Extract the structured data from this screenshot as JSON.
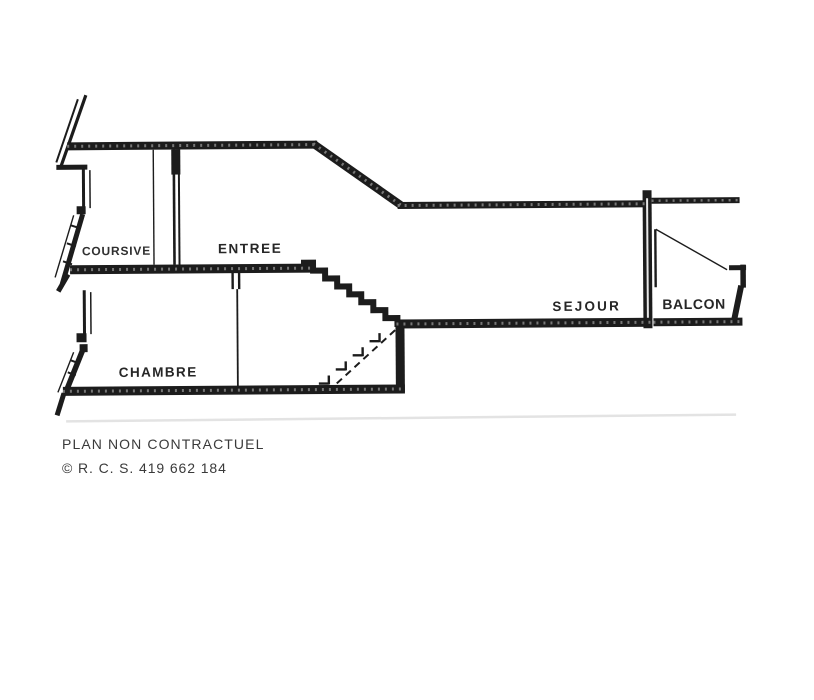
{
  "plan": {
    "rooms": [
      {
        "label": "COURSIVE"
      },
      {
        "label": "ENTREE"
      },
      {
        "label": "SEJOUR"
      },
      {
        "label": "BALCON"
      },
      {
        "label": "CHAMBRE"
      }
    ],
    "features": [
      "staircase-between-entree-and-sejour",
      "balcony-door-swing",
      "dashed-lower-stairs"
    ]
  },
  "footer": {
    "disclaimer": "PLAN NON CONTRACTUEL",
    "registration": "© R. C. S. 419 662 184"
  },
  "colors": {
    "ink": "#1c1c1c",
    "background": "#ffffff",
    "text_muted": "#3a3a3a"
  }
}
